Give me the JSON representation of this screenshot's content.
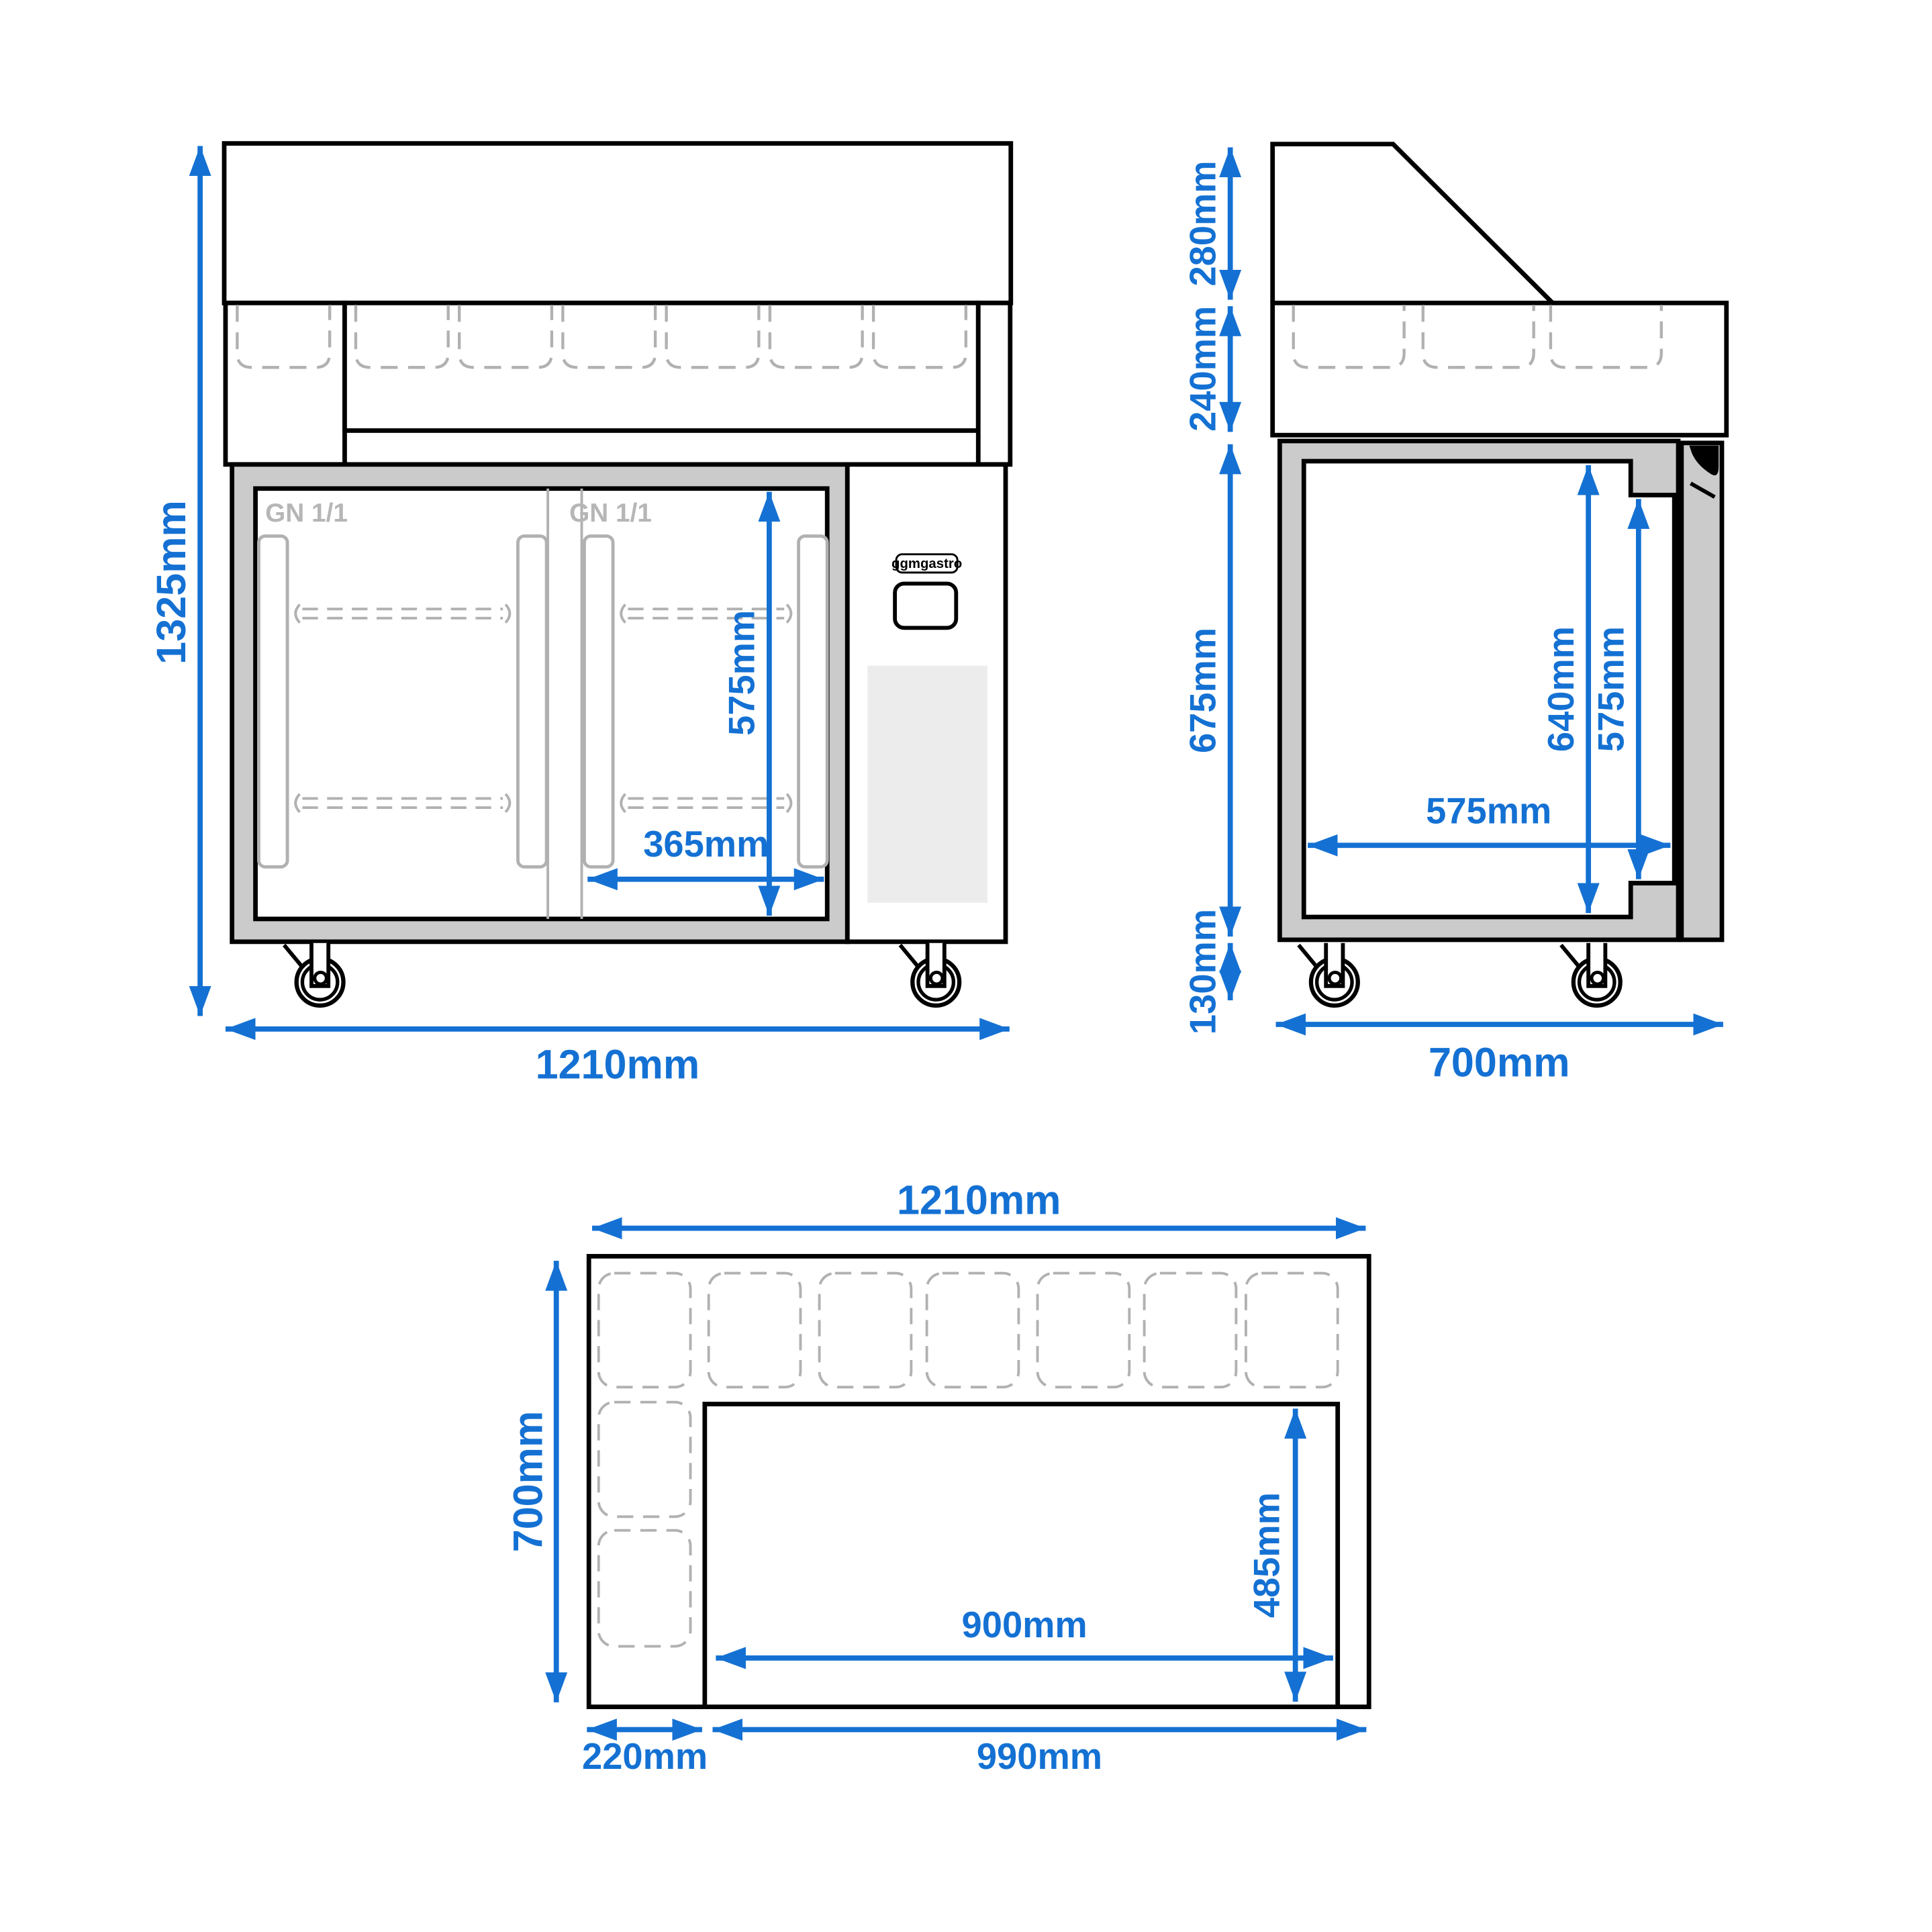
{
  "drawing_title": "refrigerated prep counter dimension drawing",
  "brand": {
    "logo": "ggmgastro"
  },
  "front": {
    "total_height": "1325mm",
    "total_width": "1210mm",
    "inner_height": "575mm",
    "door_width": "365mm",
    "gn_left": "GN 1/1",
    "gn_right": "GN 1/1"
  },
  "side": {
    "hood_height": "280mm",
    "topping_height": "240mm",
    "body_height": "675mm",
    "castor_height": "130mm",
    "total_depth": "700mm",
    "cavity_height": "640mm",
    "cavity_height_right": "575mm",
    "cavity_depth": "575mm"
  },
  "top": {
    "total_width": "1210mm",
    "total_depth": "700mm",
    "left_section": "220mm",
    "bottom_section": "990mm",
    "cutout_width": "900mm",
    "cutout_depth": "485mm"
  },
  "colors": {
    "accent": "#1471d3",
    "frame_gray": "#cbcbcb",
    "dash_gray": "#b1b1b1",
    "gn_gray": "#b6b6b6",
    "vent_gray": "#ececec",
    "line_black": "#000000"
  }
}
